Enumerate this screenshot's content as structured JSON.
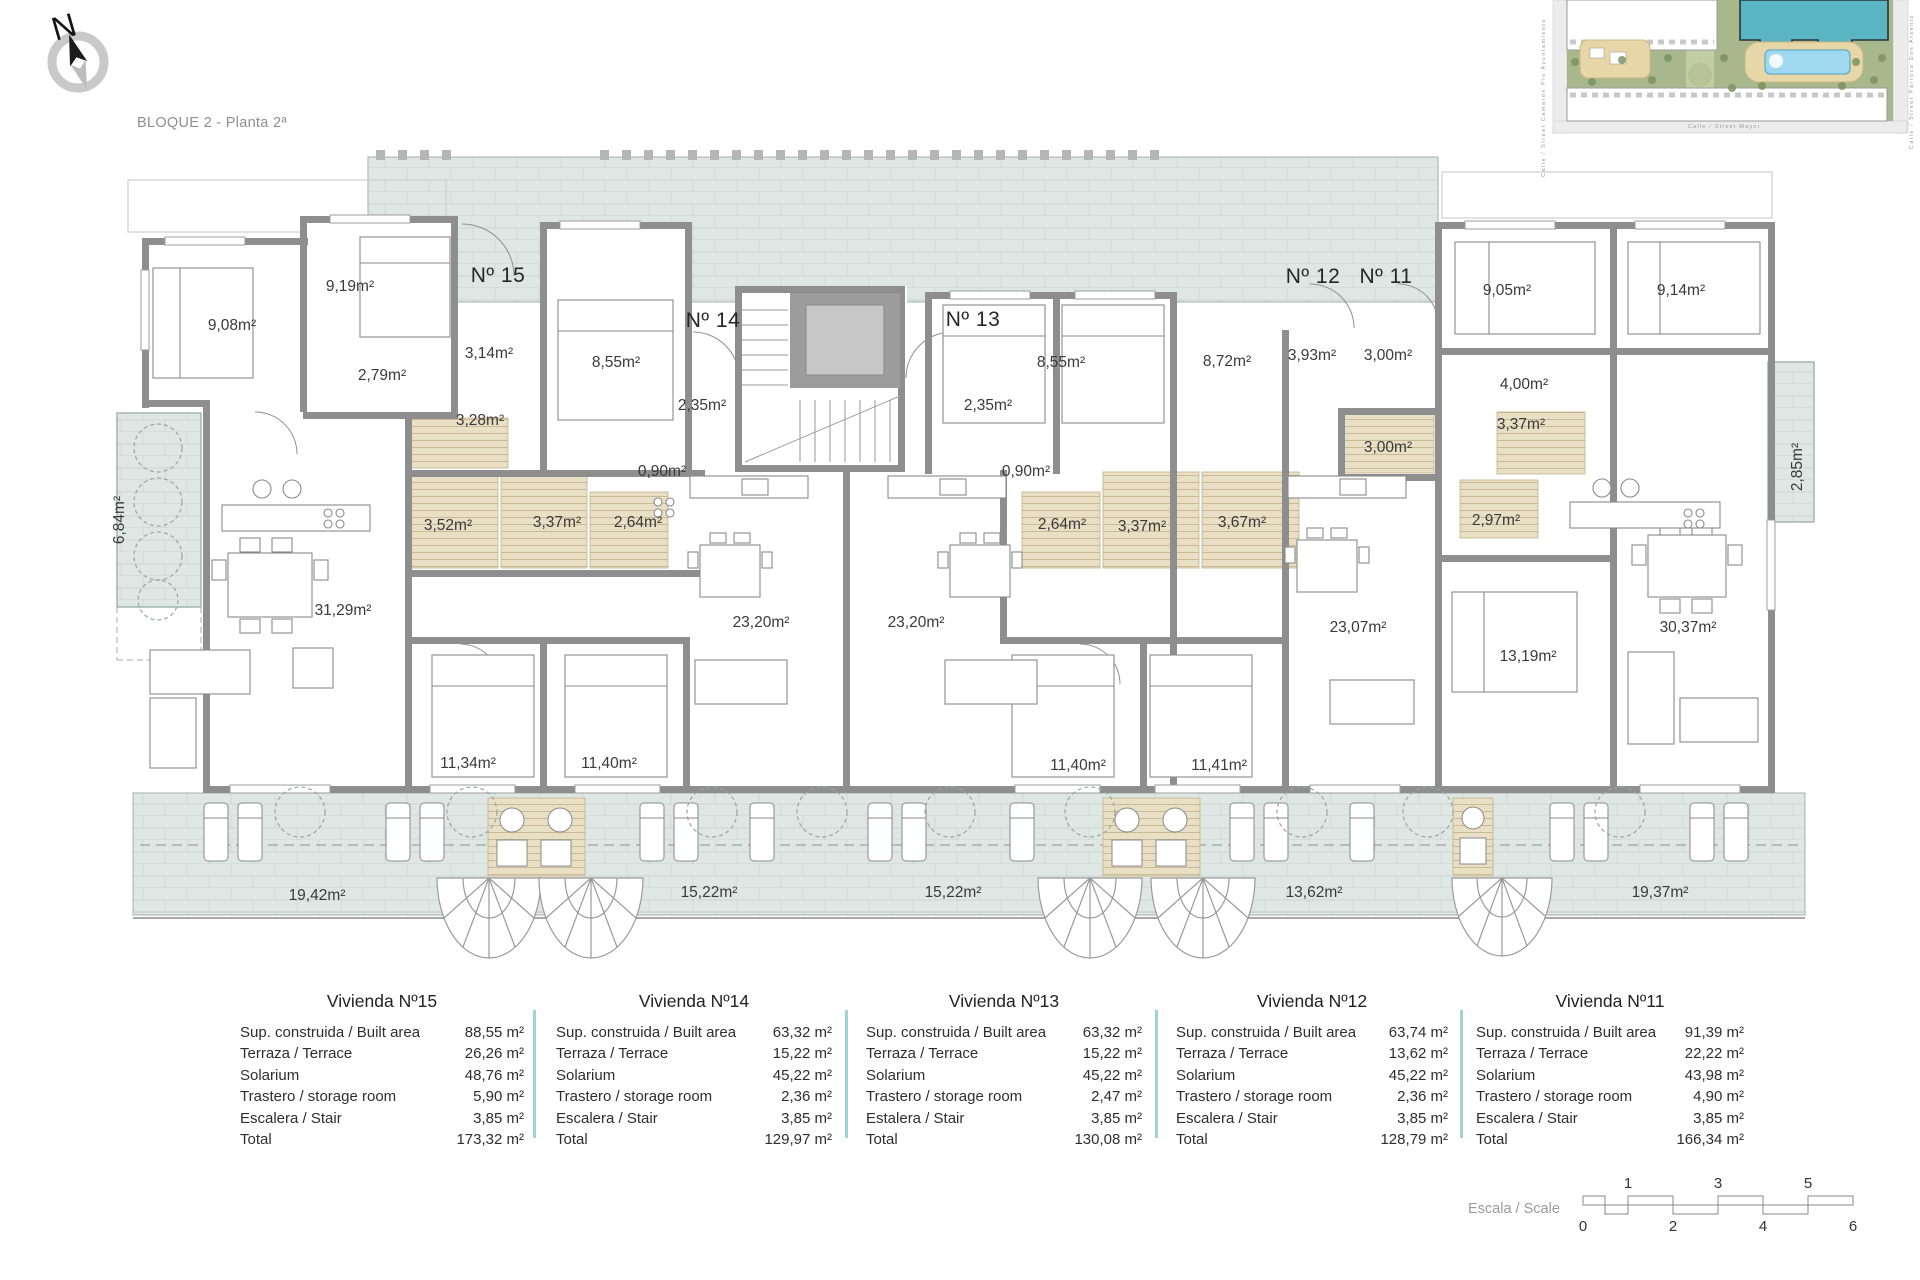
{
  "title": "BLOQUE 2 - Planta 2ª",
  "compass": {
    "north_letter": "N"
  },
  "site_plan": {
    "street_left": "Calle / Street  Camarón  Pío  Ayuntamiento",
    "street_right": "Calle / Street  Párroco  Don  Arsenio",
    "street_bottom": "Calle / Street  Mayor"
  },
  "plan": {
    "unit_labels": [
      {
        "text": "Nº 15",
        "x": 498,
        "y": 276
      },
      {
        "text": "Nº 14",
        "x": 713,
        "y": 321
      },
      {
        "text": "Nº 13",
        "x": 973,
        "y": 320
      },
      {
        "text": "Nº 12",
        "x": 1313,
        "y": 277
      },
      {
        "text": "Nº 11",
        "x": 1386,
        "y": 277
      }
    ],
    "room_labels": [
      {
        "text": "9,08m²",
        "x": 232,
        "y": 326
      },
      {
        "text": "9,19m²",
        "x": 350,
        "y": 287
      },
      {
        "text": "3,14m²",
        "x": 489,
        "y": 354
      },
      {
        "text": "2,79m²",
        "x": 382,
        "y": 376
      },
      {
        "text": "3,28m²",
        "x": 480,
        "y": 421
      },
      {
        "text": "8,55m²",
        "x": 616,
        "y": 363
      },
      {
        "text": "2,35m²",
        "x": 702,
        "y": 406
      },
      {
        "text": "0,90m²",
        "x": 662,
        "y": 472
      },
      {
        "text": "3,52m²",
        "x": 448,
        "y": 526
      },
      {
        "text": "3,37m²",
        "x": 557,
        "y": 523
      },
      {
        "text": "2,64m²",
        "x": 638,
        "y": 523
      },
      {
        "text": "31,29m²",
        "x": 343,
        "y": 611
      },
      {
        "text": "23,20m²",
        "x": 761,
        "y": 623
      },
      {
        "text": "23,20m²",
        "x": 916,
        "y": 623
      },
      {
        "text": "11,34m²",
        "x": 468,
        "y": 764
      },
      {
        "text": "11,40m²",
        "x": 609,
        "y": 764
      },
      {
        "text": "6,84m²",
        "x": 120,
        "y": 520,
        "rot": -90
      },
      {
        "text": "19,42m²",
        "x": 317,
        "y": 896
      },
      {
        "text": "15,22m²",
        "x": 709,
        "y": 893
      },
      {
        "text": "15,22m²",
        "x": 953,
        "y": 893
      },
      {
        "text": "8,55m²",
        "x": 1061,
        "y": 363
      },
      {
        "text": "8,72m²",
        "x": 1227,
        "y": 362
      },
      {
        "text": "2,35m²",
        "x": 988,
        "y": 406
      },
      {
        "text": "0,90m²",
        "x": 1026,
        "y": 472
      },
      {
        "text": "2,64m²",
        "x": 1062,
        "y": 525
      },
      {
        "text": "3,37m²",
        "x": 1142,
        "y": 527
      },
      {
        "text": "3,67m²",
        "x": 1242,
        "y": 523
      },
      {
        "text": "11,40m²",
        "x": 1078,
        "y": 766
      },
      {
        "text": "11,41m²",
        "x": 1219,
        "y": 766
      },
      {
        "text": "3,93m²",
        "x": 1312,
        "y": 356
      },
      {
        "text": "3,00m²",
        "x": 1388,
        "y": 356
      },
      {
        "text": "3,00m²",
        "x": 1388,
        "y": 448
      },
      {
        "text": "9,05m²",
        "x": 1507,
        "y": 291
      },
      {
        "text": "9,14m²",
        "x": 1681,
        "y": 291
      },
      {
        "text": "4,00m²",
        "x": 1524,
        "y": 385
      },
      {
        "text": "3,37m²",
        "x": 1521,
        "y": 425
      },
      {
        "text": "2,97m²",
        "x": 1496,
        "y": 521
      },
      {
        "text": "23,07m²",
        "x": 1358,
        "y": 628
      },
      {
        "text": "13,19m²",
        "x": 1528,
        "y": 657
      },
      {
        "text": "30,37m²",
        "x": 1688,
        "y": 628
      },
      {
        "text": "2,85m²",
        "x": 1798,
        "y": 467,
        "rot": -90
      },
      {
        "text": "13,62m²",
        "x": 1314,
        "y": 893
      },
      {
        "text": "19,37m²",
        "x": 1660,
        "y": 893
      }
    ]
  },
  "tables": [
    {
      "title": "Vivienda Nº15",
      "rows": [
        {
          "label": "Sup. construida / Built area",
          "value": "88,55 m²"
        },
        {
          "label": "Terraza / Terrace",
          "value": "26,26 m²"
        },
        {
          "label": "Solarium",
          "value": "48,76 m²"
        },
        {
          "label": "Trastero / storage room",
          "value": "5,90 m²"
        },
        {
          "label": "Escalera / Stair",
          "value": "3,85 m²"
        },
        {
          "label": "Total",
          "value": "173,32 m²"
        }
      ]
    },
    {
      "title": "Vivienda Nº14",
      "rows": [
        {
          "label": "Sup. construida / Built area",
          "value": "63,32 m²"
        },
        {
          "label": "Terraza / Terrace",
          "value": "15,22 m²"
        },
        {
          "label": "Solarium",
          "value": "45,22 m²"
        },
        {
          "label": "Trastero / storage room",
          "value": "2,36 m²"
        },
        {
          "label": "Escalera / Stair",
          "value": "3,85 m²"
        },
        {
          "label": "Total",
          "value": "129,97 m²"
        }
      ]
    },
    {
      "title": "Vivienda Nº13",
      "rows": [
        {
          "label": "Sup. construida / Built area",
          "value": "63,32 m²"
        },
        {
          "label": "Terraza / Terrace",
          "value": "15,22 m²"
        },
        {
          "label": "Solarium",
          "value": "45,22 m²"
        },
        {
          "label": "Trastero / storage room",
          "value": "2,47 m²"
        },
        {
          "label": "Estalera / Stair",
          "value": "3,85 m²"
        },
        {
          "label": "Total",
          "value": "130,08 m²"
        }
      ]
    },
    {
      "title": "Vivienda Nº12",
      "rows": [
        {
          "label": "Sup. construida / Built area",
          "value": "63,74 m²"
        },
        {
          "label": "Terraza / Terrace",
          "value": "13,62 m²"
        },
        {
          "label": "Solarium",
          "value": "45,22 m²"
        },
        {
          "label": "Trastero / storage room",
          "value": "2,36 m²"
        },
        {
          "label": "Escalera / Stair",
          "value": "3,85 m²"
        },
        {
          "label": "Total",
          "value": "128,79 m²"
        }
      ]
    },
    {
      "title": "Vivienda Nº11",
      "rows": [
        {
          "label": "Sup. construida / Built area",
          "value": "91,39 m²"
        },
        {
          "label": "Terraza / Terrace",
          "value": "22,22 m²"
        },
        {
          "label": "Solarium",
          "value": "43,98 m²"
        },
        {
          "label": "Trastero / storage room",
          "value": "4,90 m²"
        },
        {
          "label": "Escalera / Stair",
          "value": "3,85 m²"
        },
        {
          "label": "Total",
          "value": "166,34 m²"
        }
      ]
    }
  ],
  "scale_bar": {
    "label": "Escala / Scale",
    "top": [
      "1",
      "3",
      "5"
    ],
    "bottom": [
      "0",
      "2",
      "4",
      "6"
    ]
  },
  "colors": {
    "wall_gray": "#8e8e8e",
    "terrace_fill": "#dfe7e4",
    "bath_fill": "#e9dfc5",
    "table_divider": "#9fd3d8",
    "site_building_highlight": "#5ab5c2",
    "site_green": "#a9b78c",
    "pool_blue": "#9fd9f0"
  }
}
